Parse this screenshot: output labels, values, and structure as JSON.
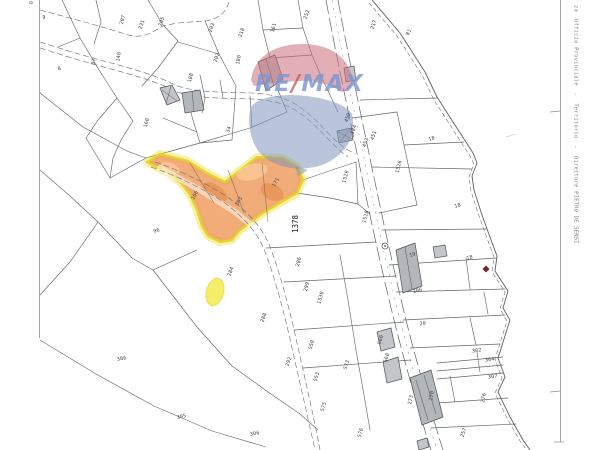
{
  "document": {
    "kind": "cadastral map extract",
    "right_margin_caption": "za  Ufficio Provinciale  -  Territorio  -  Direttore PIETRO DE SENSI",
    "corner_caption": "0"
  },
  "watermark": {
    "brand": "RE/MAX balloon",
    "text_re": "RE",
    "text_slash": "/",
    "text_max": "MAX"
  },
  "highlight": {
    "parcel_label": "1378",
    "spot_label": "189"
  },
  "colors": {
    "line": "#61676e",
    "bfill": "#c3c5c8",
    "bstroke": "#4e5257",
    "hlout": "#ece035",
    "hlfill": "#ee9a5c",
    "spot": "#f4ec52",
    "wred": "#cb6e7a",
    "wblue": "#8294be",
    "wtext": "#7a96d0",
    "wslash": "#c45c66",
    "marker": "#7e2320"
  },
  "parcels": {
    "labels": [
      {
        "t": "9",
        "x": 44,
        "y": 19,
        "r": 0
      },
      {
        "t": "8",
        "x": 60,
        "y": 70,
        "r": -20
      },
      {
        "t": "207",
        "x": 124,
        "y": 20,
        "r": -75
      },
      {
        "t": "231",
        "x": 143,
        "y": 25,
        "r": -70
      },
      {
        "t": "205",
        "x": 163,
        "y": 22,
        "r": -70
      },
      {
        "t": "203",
        "x": 213,
        "y": 28,
        "r": -70
      },
      {
        "t": "202",
        "x": 218,
        "y": 58,
        "r": -70
      },
      {
        "t": "97",
        "x": 95,
        "y": 62,
        "r": -75
      },
      {
        "t": "148",
        "x": 120,
        "y": 57,
        "r": -80
      },
      {
        "t": "218",
        "x": 243,
        "y": 33,
        "r": -70
      },
      {
        "t": "161",
        "x": 275,
        "y": 28,
        "r": -75
      },
      {
        "t": "252",
        "x": 308,
        "y": 15,
        "r": -70
      },
      {
        "t": "217",
        "x": 375,
        "y": 25,
        "r": -70
      },
      {
        "t": "81",
        "x": 410,
        "y": 33,
        "r": -60
      },
      {
        "t": "180",
        "x": 240,
        "y": 60,
        "r": -80
      },
      {
        "t": "188",
        "x": 192,
        "y": 78,
        "r": -75
      },
      {
        "t": "160",
        "x": 148,
        "y": 123,
        "r": -75
      },
      {
        "t": "34",
        "x": 230,
        "y": 130,
        "r": -70
      },
      {
        "t": "96",
        "x": 157,
        "y": 232,
        "r": -15
      },
      {
        "t": "166",
        "x": 196,
        "y": 196,
        "r": -60
      },
      {
        "t": "303",
        "x": 240,
        "y": 202,
        "r": -60
      },
      {
        "t": "171",
        "x": 277,
        "y": 183,
        "r": -60
      },
      {
        "t": "459",
        "x": 349,
        "y": 118,
        "r": -70
      },
      {
        "t": "184",
        "x": 355,
        "y": 130,
        "r": -70
      },
      {
        "t": "453",
        "x": 367,
        "y": 143,
        "r": -70
      },
      {
        "t": "451",
        "x": 375,
        "y": 136,
        "r": -70
      },
      {
        "t": "1529",
        "x": 347,
        "y": 177,
        "r": -75
      },
      {
        "t": "1526",
        "x": 400,
        "y": 167,
        "r": -75
      },
      {
        "t": "1528",
        "x": 367,
        "y": 217,
        "r": -75
      },
      {
        "t": "18",
        "x": 432,
        "y": 140,
        "r": -15
      },
      {
        "t": "18",
        "x": 458,
        "y": 207,
        "r": -15
      },
      {
        "t": "18",
        "x": 470,
        "y": 259,
        "r": -15
      },
      {
        "t": "19",
        "x": 413,
        "y": 256,
        "r": -20
      },
      {
        "t": "206",
        "x": 418,
        "y": 292,
        "r": -15
      },
      {
        "t": "20",
        "x": 423,
        "y": 325,
        "r": -10
      },
      {
        "t": "286",
        "x": 300,
        "y": 262,
        "r": -75
      },
      {
        "t": "299",
        "x": 308,
        "y": 287,
        "r": -75
      },
      {
        "t": "1530",
        "x": 322,
        "y": 298,
        "r": -75
      },
      {
        "t": "284",
        "x": 232,
        "y": 272,
        "r": -70
      },
      {
        "t": "288",
        "x": 265,
        "y": 318,
        "r": -70
      },
      {
        "t": "292",
        "x": 290,
        "y": 362,
        "r": -70
      },
      {
        "t": "550",
        "x": 313,
        "y": 345,
        "r": -75
      },
      {
        "t": "553",
        "x": 318,
        "y": 377,
        "r": -75
      },
      {
        "t": "575",
        "x": 325,
        "y": 407,
        "r": -75
      },
      {
        "t": "573",
        "x": 348,
        "y": 365,
        "r": -75
      },
      {
        "t": "576",
        "x": 362,
        "y": 433,
        "r": -75
      },
      {
        "t": "386",
        "x": 122,
        "y": 360,
        "r": -10
      },
      {
        "t": "305",
        "x": 182,
        "y": 418,
        "r": -15
      },
      {
        "t": "306",
        "x": 255,
        "y": 435,
        "r": -10
      },
      {
        "t": "560",
        "x": 382,
        "y": 340,
        "r": -75
      },
      {
        "t": "568",
        "x": 388,
        "y": 358,
        "r": -75
      },
      {
        "t": "273",
        "x": 412,
        "y": 400,
        "r": -80
      },
      {
        "t": "270",
        "x": 433,
        "y": 396,
        "r": -80
      },
      {
        "t": "302",
        "x": 477,
        "y": 352,
        "r": -8
      },
      {
        "t": "304",
        "x": 490,
        "y": 361,
        "r": -8
      },
      {
        "t": "307",
        "x": 493,
        "y": 378,
        "r": -8
      },
      {
        "t": "276",
        "x": 485,
        "y": 398,
        "r": -80
      },
      {
        "t": "257",
        "x": 465,
        "y": 433,
        "r": -70
      }
    ]
  }
}
